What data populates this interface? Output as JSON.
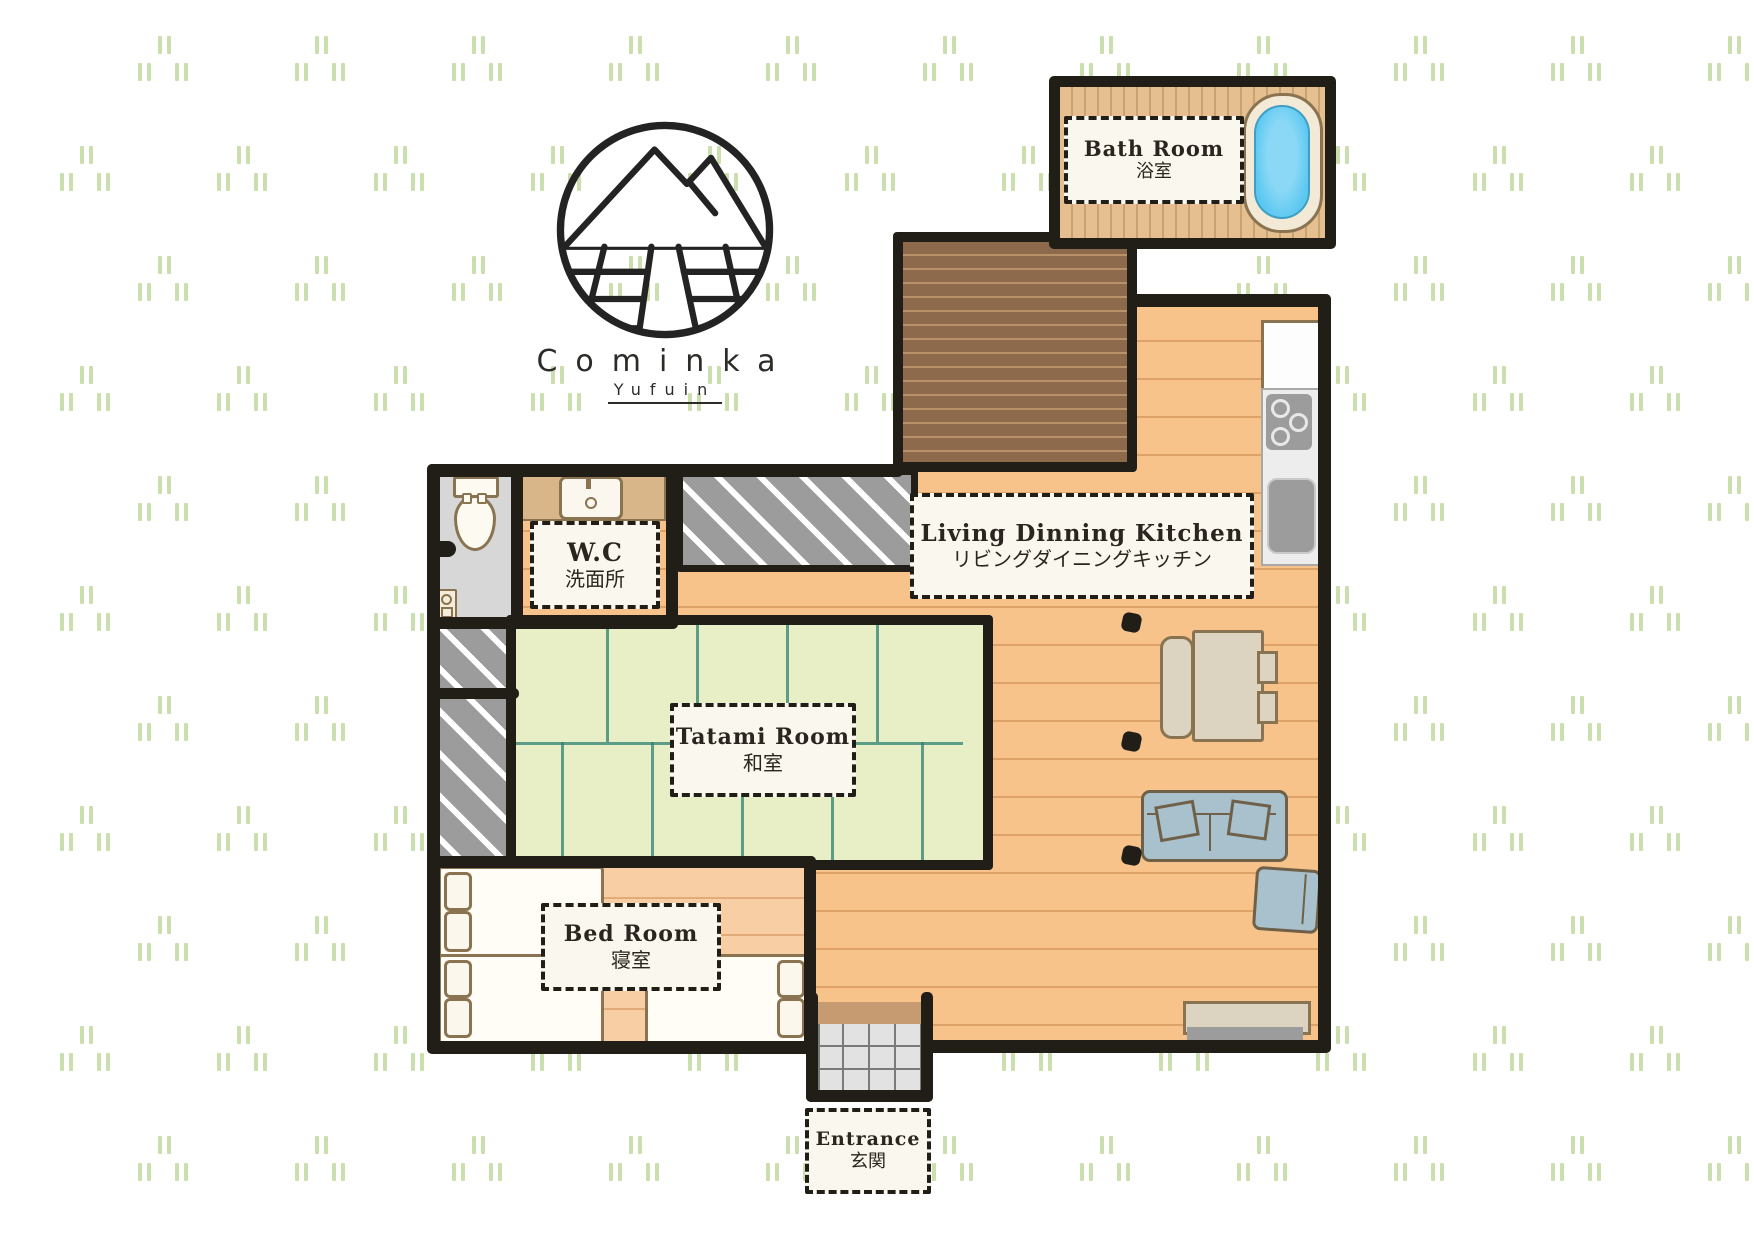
{
  "logo": {
    "name": "Cominka",
    "subtitle": "Yufuin"
  },
  "labels": {
    "bath": {
      "en": "Bath Room",
      "ja": "浴室"
    },
    "ldk": {
      "en": "Living Dinning Kitchen",
      "ja": "リビングダイニングキッチン"
    },
    "wc": {
      "en": "W.C",
      "ja": "洗面所"
    },
    "tatami": {
      "en": "Tatami Room",
      "ja": "和室"
    },
    "bed": {
      "en": "Bed Room",
      "ja": "寝室"
    },
    "entrance": {
      "en": "Entrance",
      "ja": "玄関"
    }
  },
  "colors": {
    "wall": "#211e18",
    "ink": "#2a251f",
    "floor": "#f7c38a",
    "floorline": "#dda268",
    "bedfloor": "#f8cfa4",
    "bedfloorline": "#e2ab79",
    "deck": "#8d6a4b",
    "deckline": "#b99067",
    "bath": "#e5bf90",
    "bathstripe": "#c9a271",
    "tatami": "#e8eec6",
    "tatamiline": "#2f8173",
    "grayfloor": "#d7d7d7",
    "hatch": "#9c9c9c",
    "labelbg": "#faf7ee",
    "furn": "#ddd3c1",
    "furnline": "#8a7350",
    "sofa": "#a9c1cc",
    "sofaline": "#6f6049",
    "tub": "#5cc8f1",
    "tubrim": "#f2ead6",
    "tile": "#e2e2e2",
    "tileline": "#7a7a7a",
    "step": "#c79b72",
    "pattern": "#cbdfae"
  }
}
